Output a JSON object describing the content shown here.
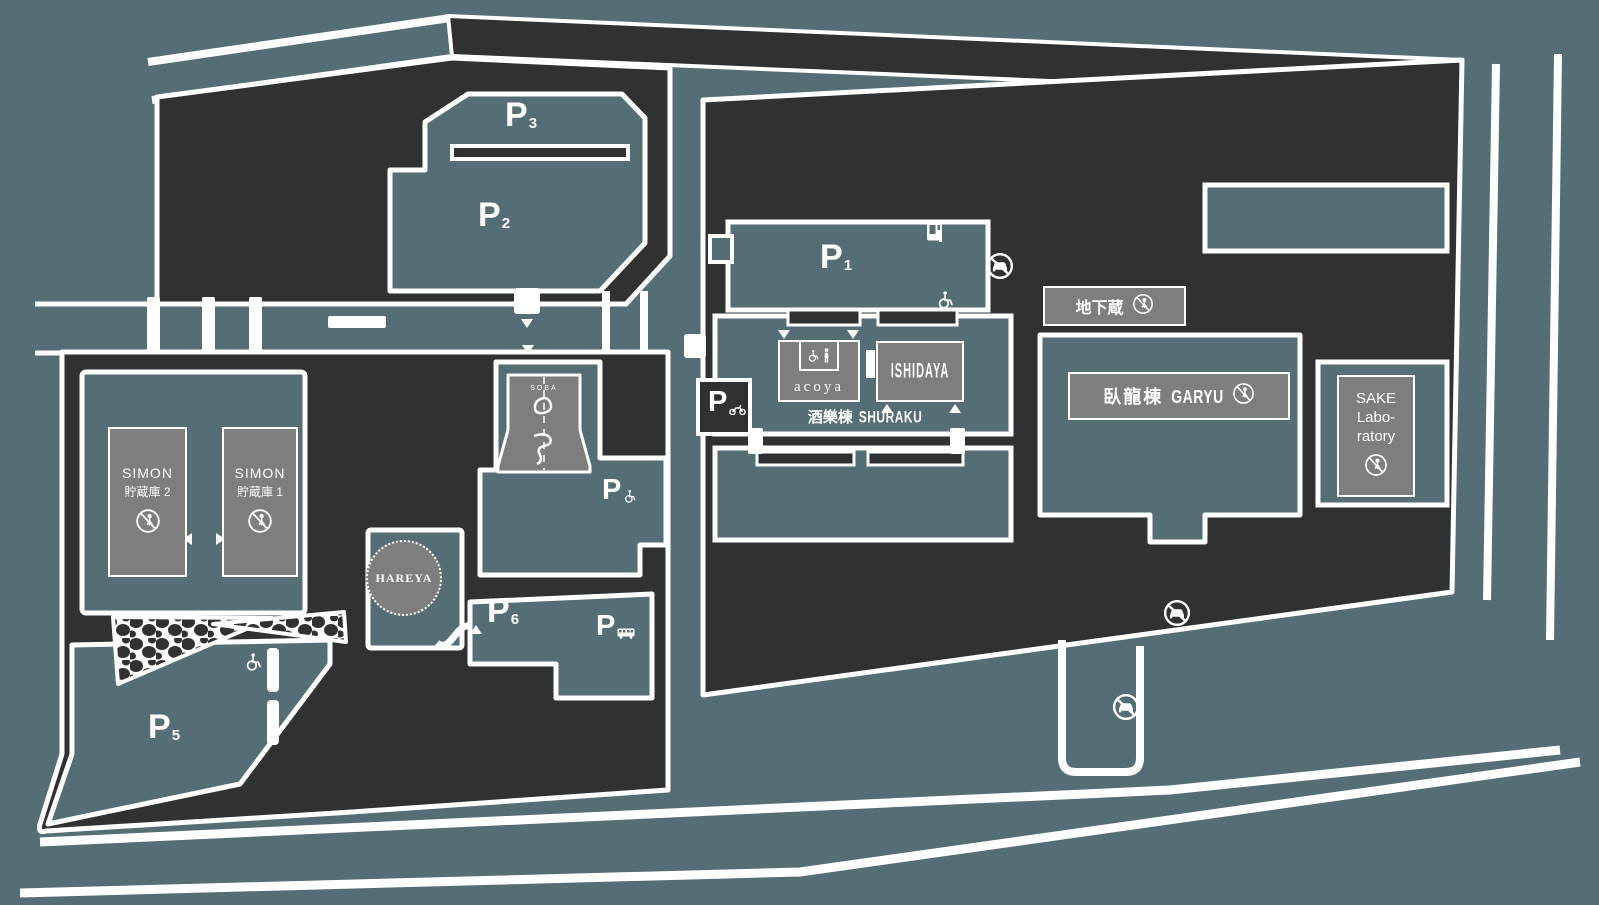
{
  "colors": {
    "background": "#556E76",
    "block_dark": "#2F3133",
    "building_gray": "#7E7E7E",
    "road_white": "#FFFFFF"
  },
  "parking": {
    "p1": {
      "label": "P",
      "sub": "1"
    },
    "p2": {
      "label": "P",
      "sub": "2"
    },
    "p3": {
      "label": "P",
      "sub": "3"
    },
    "p5": {
      "label": "P",
      "sub": "5"
    },
    "p6": {
      "label": "P",
      "sub": "6"
    },
    "p_accessible": {
      "label": "P",
      "sub_icon": "wheelchair-icon"
    },
    "p_bus": {
      "label": "P",
      "sub_icon": "bus-icon"
    },
    "p_motorcycle": {
      "label": "P",
      "sub_icon": "motorcycle-icon"
    }
  },
  "buildings": {
    "simon2": {
      "name": "SIMON",
      "floor": "貯蔵庫 2"
    },
    "simon1": {
      "name": "SIMON",
      "floor": "貯蔵庫 1"
    },
    "hareya": {
      "name": "HAREYA"
    },
    "soba": {
      "name": "SOBA"
    },
    "acoya": {
      "name": "acoya"
    },
    "ishidaya": {
      "name": "ISHIDAYA"
    },
    "shuraku": {
      "jp": "酒樂棟",
      "en": "SHURAKU"
    },
    "chikagura": {
      "jp": "地下蔵"
    },
    "garyu": {
      "jp": "臥龍棟",
      "en": "GARYU"
    },
    "sake_laboratory": {
      "line1": "SAKE",
      "line2": "Labo-",
      "line3": "ratory"
    }
  },
  "icons": {
    "no_entry": "no-entry-person-icon",
    "no_cars": "no-cars-icon",
    "wheelchair": "wheelchair-icon",
    "accessible_toilet": "accessible-toilet-icon",
    "vending": "vending-machine-icon",
    "bus": "bus-icon",
    "motorcycle": "motorcycle-icon"
  }
}
